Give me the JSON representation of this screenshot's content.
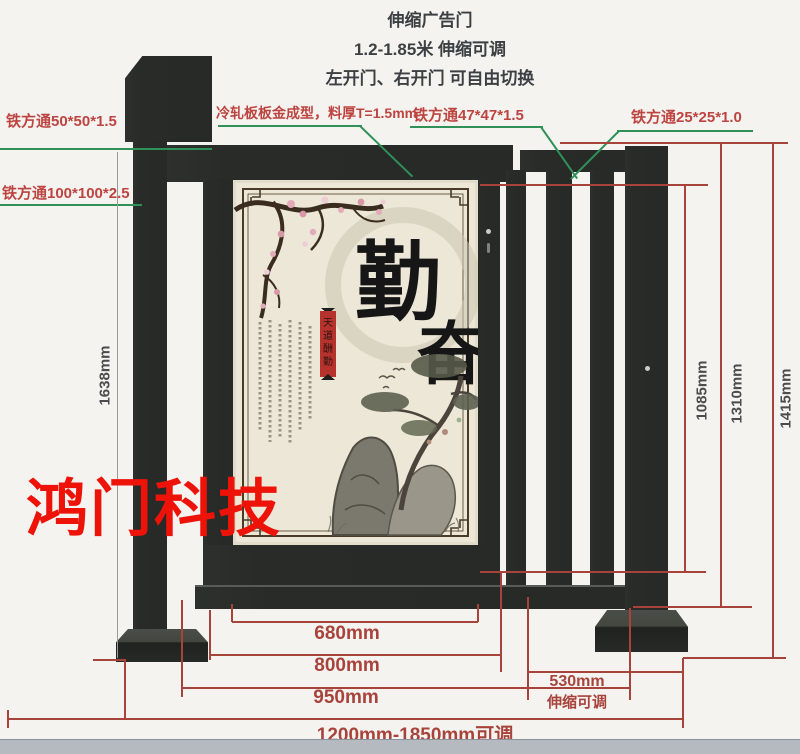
{
  "title": {
    "line1": "伸缩广告门",
    "line2": "1.2-1.85米 伸缩可调",
    "line3": "左开门、右开门 可自由切换"
  },
  "watermark": "鸿门科技",
  "callouts": {
    "tube50": "铁方通50*50*1.5",
    "tube100": "铁方通100*100*2.5",
    "cold_rolled": "冷轧板板金成型，料厚T=1.5mm",
    "tube47": "铁方通47*47*1.5",
    "tube25": "铁方通25*25*1.0"
  },
  "dimensions": {
    "total_height": "1638mm",
    "h1085": "1085mm",
    "h1310": "1310mm",
    "h1415": "1415mm",
    "w680": "680mm",
    "w800": "800mm",
    "w950": "950mm",
    "range": "1200mm-1850mm可调",
    "telescopic_value": "530mm",
    "telescopic_note": "伸缩可调"
  },
  "poster": {
    "char_main_1": "勤",
    "char_main_2": "奋",
    "banner_chars": [
      "天",
      "道",
      "酬",
      "勤"
    ]
  },
  "colors": {
    "dimension_red": "#a8433c",
    "leader_green": "#2f9158",
    "frame_dark": "#282b28",
    "watermark_red": "#ee1309",
    "poster_beige": "#ece7d6"
  }
}
